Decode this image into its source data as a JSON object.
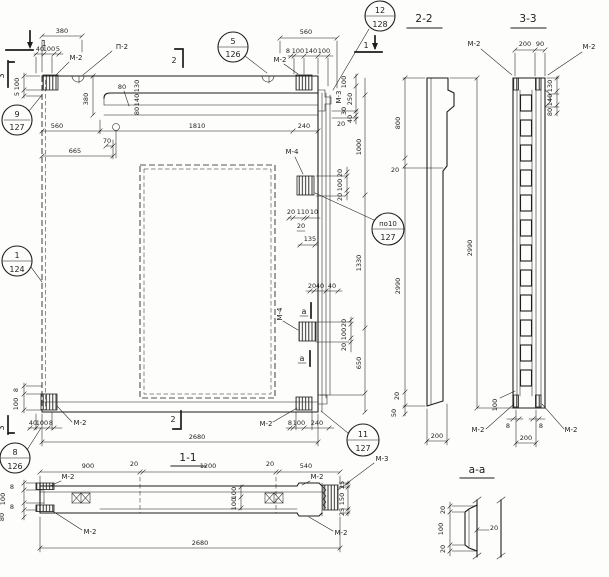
{
  "page": {
    "background": "#fdfdfb",
    "ink": "#1d1d1b"
  },
  "titles": {
    "s22": "2-2",
    "s33": "3-3",
    "s11": "1-1",
    "saa": "а-а"
  },
  "cuts": {
    "one": "1",
    "two": "2",
    "three": "3",
    "a": "а"
  },
  "marks": {
    "m2": "М-2",
    "m3": "М-3",
    "m4": "М-4",
    "p2": "П-2"
  },
  "callouts": {
    "c9": {
      "num": "9",
      "ref": "127"
    },
    "c5": {
      "num": "5",
      "ref": "126"
    },
    "c12": {
      "num": "12",
      "ref": "128"
    },
    "c1": {
      "num": "1",
      "ref": "124"
    },
    "cpo": {
      "num": "по10",
      "ref": "127"
    },
    "c8": {
      "num": "8",
      "ref": "126"
    },
    "c11": {
      "num": "11",
      "ref": "127"
    }
  },
  "dims": {
    "d380": "380",
    "d40a": "40",
    "d100a": "100",
    "d5a": "5",
    "v100a": "100",
    "v5a": "5",
    "d560l": "560",
    "v380": "380",
    "d665": "665",
    "d70": "70",
    "b130": "130",
    "b140": "140",
    "b80": "80",
    "b80b": "80",
    "d1810": "1810",
    "d240a": "240",
    "d560t": "560",
    "d8a": "8",
    "d100b": "100",
    "d140a": "140",
    "d100c": "100",
    "r100": "100",
    "r250": "250",
    "r30": "30",
    "r40": "40",
    "r20": "20",
    "v1000": "1000",
    "v1330": "1330",
    "v650": "650",
    "ma20a": "20",
    "ma100": "100",
    "ma20b": "20",
    "j20a": "20",
    "j110": "110",
    "j10": "10",
    "j20b": "20",
    "j135": "135",
    "k20": "20",
    "k40a": "40",
    "k40b": "40",
    "mb20a": "20",
    "mb100": "100",
    "mb20b": "20",
    "bl8v": "8",
    "bl100v": "100",
    "bl40": "40",
    "bl100": "100",
    "bl8": "8",
    "d2680": "2680",
    "br8": "8",
    "br100": "100",
    "br240": "240",
    "s800": "800",
    "s20a": "20",
    "s2990": "2990",
    "s20b": "20",
    "s50": "50",
    "s200": "200",
    "s2990b": "2990",
    "q200": "200",
    "q90": "90",
    "q130": "130",
    "q140": "140",
    "q80": "80",
    "q8a": "8",
    "q8b": "8",
    "q100": "100",
    "q200b": "200",
    "h900": "900",
    "h20a": "20",
    "h1200": "1200",
    "h20b": "20",
    "h540": "540",
    "h8a": "8",
    "h100a": "100",
    "h8b": "8",
    "h80": "80",
    "h100m1": "100",
    "h100m2": "100",
    "h25a": "25",
    "h150": "150",
    "h25b": "25",
    "h2680": "2680",
    "a20a": "20",
    "a100": "100",
    "a20b": "20",
    "a20c": "20"
  }
}
